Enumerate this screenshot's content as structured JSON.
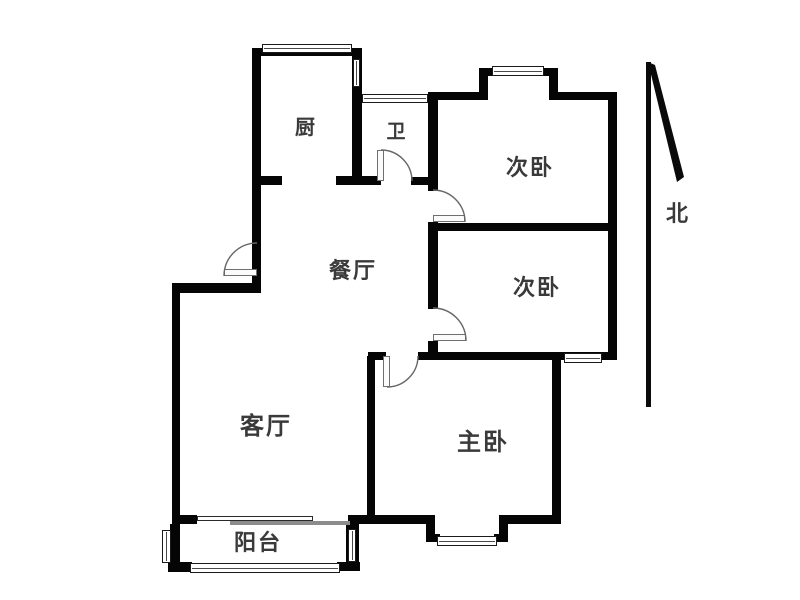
{
  "colors": {
    "background": "#ffffff",
    "wall": "#050505",
    "label": "#3a3a3a",
    "door_arc": "#666666"
  },
  "rooms": [
    {
      "id": "kitchen",
      "label": "厨",
      "cx": 306,
      "cy": 128,
      "size": 20
    },
    {
      "id": "bathroom",
      "label": "卫",
      "cx": 397,
      "cy": 132,
      "size": 19
    },
    {
      "id": "second-bedroom-1",
      "label": "次卧",
      "cx": 530,
      "cy": 168,
      "size": 22
    },
    {
      "id": "second-bedroom-2",
      "label": "次卧",
      "cx": 537,
      "cy": 288,
      "size": 22
    },
    {
      "id": "dining-room",
      "label": "餐厅",
      "cx": 353,
      "cy": 271,
      "size": 22
    },
    {
      "id": "living-room",
      "label": "客厅",
      "cx": 266,
      "cy": 427,
      "size": 24
    },
    {
      "id": "master-bedroom",
      "label": "主卧",
      "cx": 483,
      "cy": 443,
      "size": 24
    },
    {
      "id": "balcony",
      "label": "阳台",
      "cx": 258,
      "cy": 543,
      "size": 22
    }
  ],
  "compass": {
    "label": "北",
    "cx": 678,
    "cy": 214,
    "size": 22,
    "line": [
      646,
      62,
      5,
      345
    ],
    "head_polygon": "648,62 655,65 684,177 677,182"
  },
  "plan": {
    "walls": [
      {
        "id": "kitchen-top",
        "rect": [
          252,
          48,
          110,
          8
        ]
      },
      {
        "id": "kitchen-left",
        "rect": [
          252,
          48,
          9,
          245
        ]
      },
      {
        "id": "entry-top",
        "rect": [
          172,
          283,
          89,
          10
        ]
      },
      {
        "id": "kitchen-right",
        "rect": [
          352,
          56,
          10,
          129
        ]
      },
      {
        "id": "kitchen-bottom-left",
        "rect": [
          252,
          176,
          30,
          9
        ]
      },
      {
        "id": "kitchen-bottom-right",
        "rect": [
          336,
          176,
          45,
          9
        ]
      },
      {
        "id": "bathroom-bottom-right",
        "rect": [
          411,
          177,
          26,
          8
        ]
      },
      {
        "id": "bedrooms-left-a",
        "rect": [
          428,
          95,
          10,
          96
        ]
      },
      {
        "id": "bedrooms-left-b",
        "rect": [
          428,
          222,
          10,
          87
        ]
      },
      {
        "id": "bedrooms-left-c",
        "rect": [
          428,
          341,
          10,
          19
        ]
      },
      {
        "id": "bedroom1-top-left",
        "rect": [
          428,
          92,
          57,
          8
        ]
      },
      {
        "id": "bedroom1-bay-left",
        "rect": [
          479,
          68,
          9,
          32
        ]
      },
      {
        "id": "bedroom1-bay-cap-left",
        "rect": [
          479,
          68,
          17,
          8
        ]
      },
      {
        "id": "bedroom1-bay-cap-right",
        "rect": [
          541,
          68,
          17,
          8
        ]
      },
      {
        "id": "bedroom1-bay-right",
        "rect": [
          549,
          68,
          9,
          32
        ]
      },
      {
        "id": "bedroom1-top-right",
        "rect": [
          549,
          92,
          68,
          8
        ]
      },
      {
        "id": "east-exterior",
        "rect": [
          608,
          92,
          9,
          268
        ]
      },
      {
        "id": "bedrooms-divider",
        "rect": [
          428,
          223,
          189,
          8
        ]
      },
      {
        "id": "master-top-right",
        "rect": [
          418,
          352,
          199,
          8
        ]
      },
      {
        "id": "master-top-left",
        "rect": [
          368,
          352,
          18,
          8
        ]
      },
      {
        "id": "master-right",
        "rect": [
          552,
          356,
          9,
          166
        ]
      },
      {
        "id": "living-master-divider",
        "rect": [
          367,
          356,
          8,
          161
        ]
      },
      {
        "id": "living-left",
        "rect": [
          172,
          283,
          8,
          244
        ]
      },
      {
        "id": "living-bottom-stub",
        "rect": [
          172,
          515,
          25,
          9
        ]
      },
      {
        "id": "living-master-bottom",
        "rect": [
          348,
          515,
          84,
          9
        ]
      },
      {
        "id": "master-bay-left",
        "rect": [
          426,
          515,
          9,
          27
        ]
      },
      {
        "id": "master-bay-cap-left",
        "rect": [
          426,
          534,
          14,
          8
        ]
      },
      {
        "id": "master-bay-cap-right",
        "rect": [
          494,
          534,
          14,
          8
        ]
      },
      {
        "id": "master-bay-right",
        "rect": [
          499,
          515,
          9,
          27
        ]
      },
      {
        "id": "master-bottom-right",
        "rect": [
          505,
          515,
          56,
          9
        ]
      },
      {
        "id": "balcony-left",
        "rect": [
          170,
          524,
          10,
          48
        ]
      },
      {
        "id": "balcony-cap-left",
        "rect": [
          168,
          562,
          24,
          10
        ]
      },
      {
        "id": "balcony-right",
        "rect": [
          346,
          524,
          13,
          46
        ]
      },
      {
        "id": "balcony-cap-right",
        "rect": [
          337,
          562,
          23,
          9
        ]
      }
    ],
    "windows": [
      {
        "id": "window-kitchen-top",
        "rect": [
          262,
          44,
          90,
          9
        ],
        "orient": "h"
      },
      {
        "id": "window-kitchen-right",
        "rect": [
          353,
          59,
          7,
          28
        ],
        "orient": "v"
      },
      {
        "id": "window-bathroom-top",
        "rect": [
          362,
          94,
          66,
          9
        ],
        "orient": "h"
      },
      {
        "id": "window-bedroom1-bay",
        "rect": [
          492,
          66,
          52,
          10
        ],
        "orient": "h"
      },
      {
        "id": "window-bedroom2-south",
        "rect": [
          564,
          353,
          38,
          10
        ],
        "orient": "h"
      },
      {
        "id": "window-master-bay",
        "rect": [
          437,
          536,
          60,
          10
        ],
        "orient": "h"
      },
      {
        "id": "window-balcony-left",
        "rect": [
          162,
          530,
          9,
          33
        ],
        "orient": "v"
      },
      {
        "id": "window-balcony-bottom",
        "rect": [
          190,
          563,
          150,
          10
        ],
        "orient": "h"
      },
      {
        "id": "window-balcony-right",
        "rect": [
          348,
          529,
          8,
          33
        ],
        "orient": "v"
      }
    ],
    "sliding_door": [
      {
        "id": "balcony-slider-outline",
        "rect": [
          197,
          516,
          116,
          5
        ],
        "style": "outline"
      },
      {
        "id": "balcony-slider-solid",
        "rect": [
          230,
          521,
          120,
          4
        ],
        "style": "solid"
      }
    ],
    "doors": [
      {
        "id": "door-entry",
        "arc": "M 224 276 A 33 33 0 0 1 257 243",
        "leaf": [
          224,
          269,
          33,
          7
        ]
      },
      {
        "id": "door-bathroom",
        "arc": "M 381 150 A 31 31 0 0 1 412 181",
        "leaf": [
          377,
          150,
          7,
          31
        ]
      },
      {
        "id": "door-bedroom1",
        "arc": "M 433 190 A 32 32 0 0 1 465 222",
        "leaf": [
          433,
          215,
          32,
          7
        ]
      },
      {
        "id": "door-bedroom2",
        "arc": "M 433 308 A 33 33 0 0 1 466 341",
        "leaf": [
          433,
          334,
          33,
          7
        ]
      },
      {
        "id": "door-master",
        "arc": "M 418 356 A 31 31 0 0 1 387 387",
        "leaf": [
          383,
          356,
          7,
          31
        ]
      }
    ]
  }
}
